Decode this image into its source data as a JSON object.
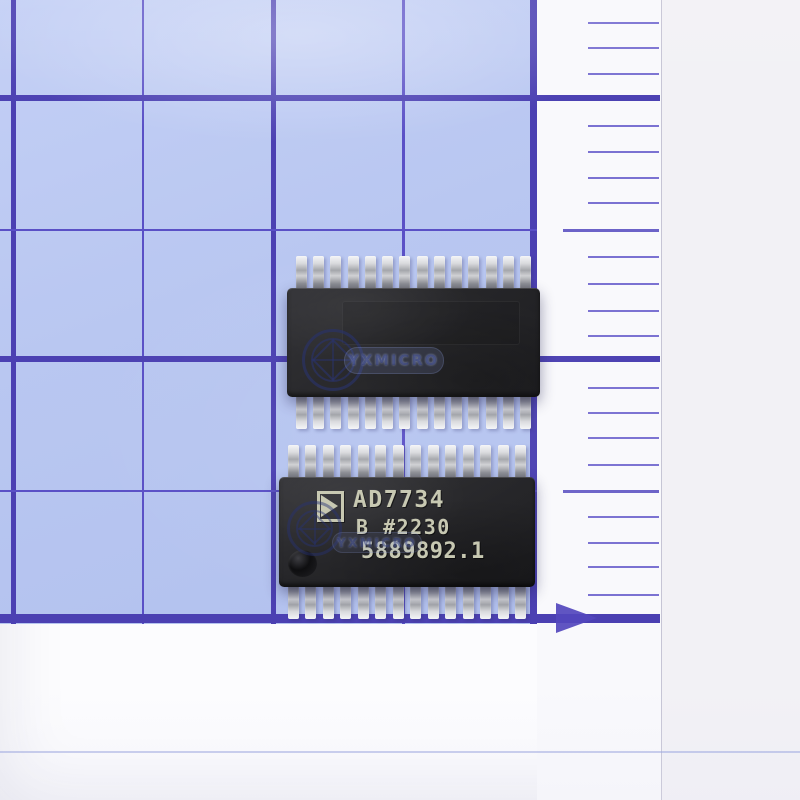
{
  "scene": {
    "subject": "Two TSSOP-28 surface-mount integrated circuits lying on blue 5mm grid paper next to a millimeter ruler edge",
    "watermark_text": "YXMICRO"
  },
  "colors": {
    "paper": "#b9c7f1",
    "grid_thick": "#4b40b2",
    "grid_thin": "#5a50c6",
    "tick": "#7b72d2",
    "tick_long": "#6c63c8",
    "arrow": "#5347bd",
    "marking": "#c6c7b0",
    "wm": "rgba(34,46,112,0.55)",
    "faint_line": "#97a2dd"
  },
  "chips": {
    "top": {
      "label": "blank back side, no marking",
      "pins_per_side": 14
    },
    "bottom": {
      "logo_icon": "analog-devices-triangle-icon",
      "marking_line1": "AD7734",
      "marking_line2": "B #2230",
      "marking_line3": "5889892.1",
      "pins_per_side": 14
    }
  },
  "grid": {
    "v_lines": [
      {
        "x": 11,
        "w": 5,
        "kind": "thick"
      },
      {
        "x": 142,
        "w": 2,
        "kind": "thin"
      },
      {
        "x": 271,
        "w": 5,
        "kind": "thick"
      },
      {
        "x": 402,
        "w": 3,
        "kind": "thin"
      },
      {
        "x": 530,
        "w": 7,
        "kind": "thick"
      }
    ],
    "h_lines_thin": [
      {
        "y": 229,
        "h": 2
      },
      {
        "y": 490,
        "h": 2
      }
    ],
    "h_lines_thick": [
      {
        "y": 95,
        "h": 6
      },
      {
        "y": 356,
        "h": 6
      },
      {
        "y": 614,
        "h": 9
      }
    ],
    "paper_w": 537,
    "paper_h": 624,
    "thick_extend_to": 660
  },
  "ruler": {
    "short_tick_y": [
      23,
      48,
      74,
      126,
      152,
      178,
      203,
      257,
      284,
      311,
      336,
      388,
      413,
      438,
      465,
      517,
      543,
      567,
      595
    ],
    "long_tick_y": [
      230,
      491
    ],
    "short_tick_left": 588,
    "long_tick_left": 563,
    "tick_right": 659,
    "arrow_x": 556,
    "arrow_y": 618
  },
  "geometry": {
    "chip_top_body": {
      "x": 287,
      "y": 288,
      "w": 253,
      "h": 109
    },
    "chip_bottom_body": {
      "x": 279,
      "y": 477,
      "w": 256,
      "h": 110
    },
    "pin": {
      "w": 11,
      "h": 34,
      "inset": 9,
      "overlap": 2
    }
  }
}
